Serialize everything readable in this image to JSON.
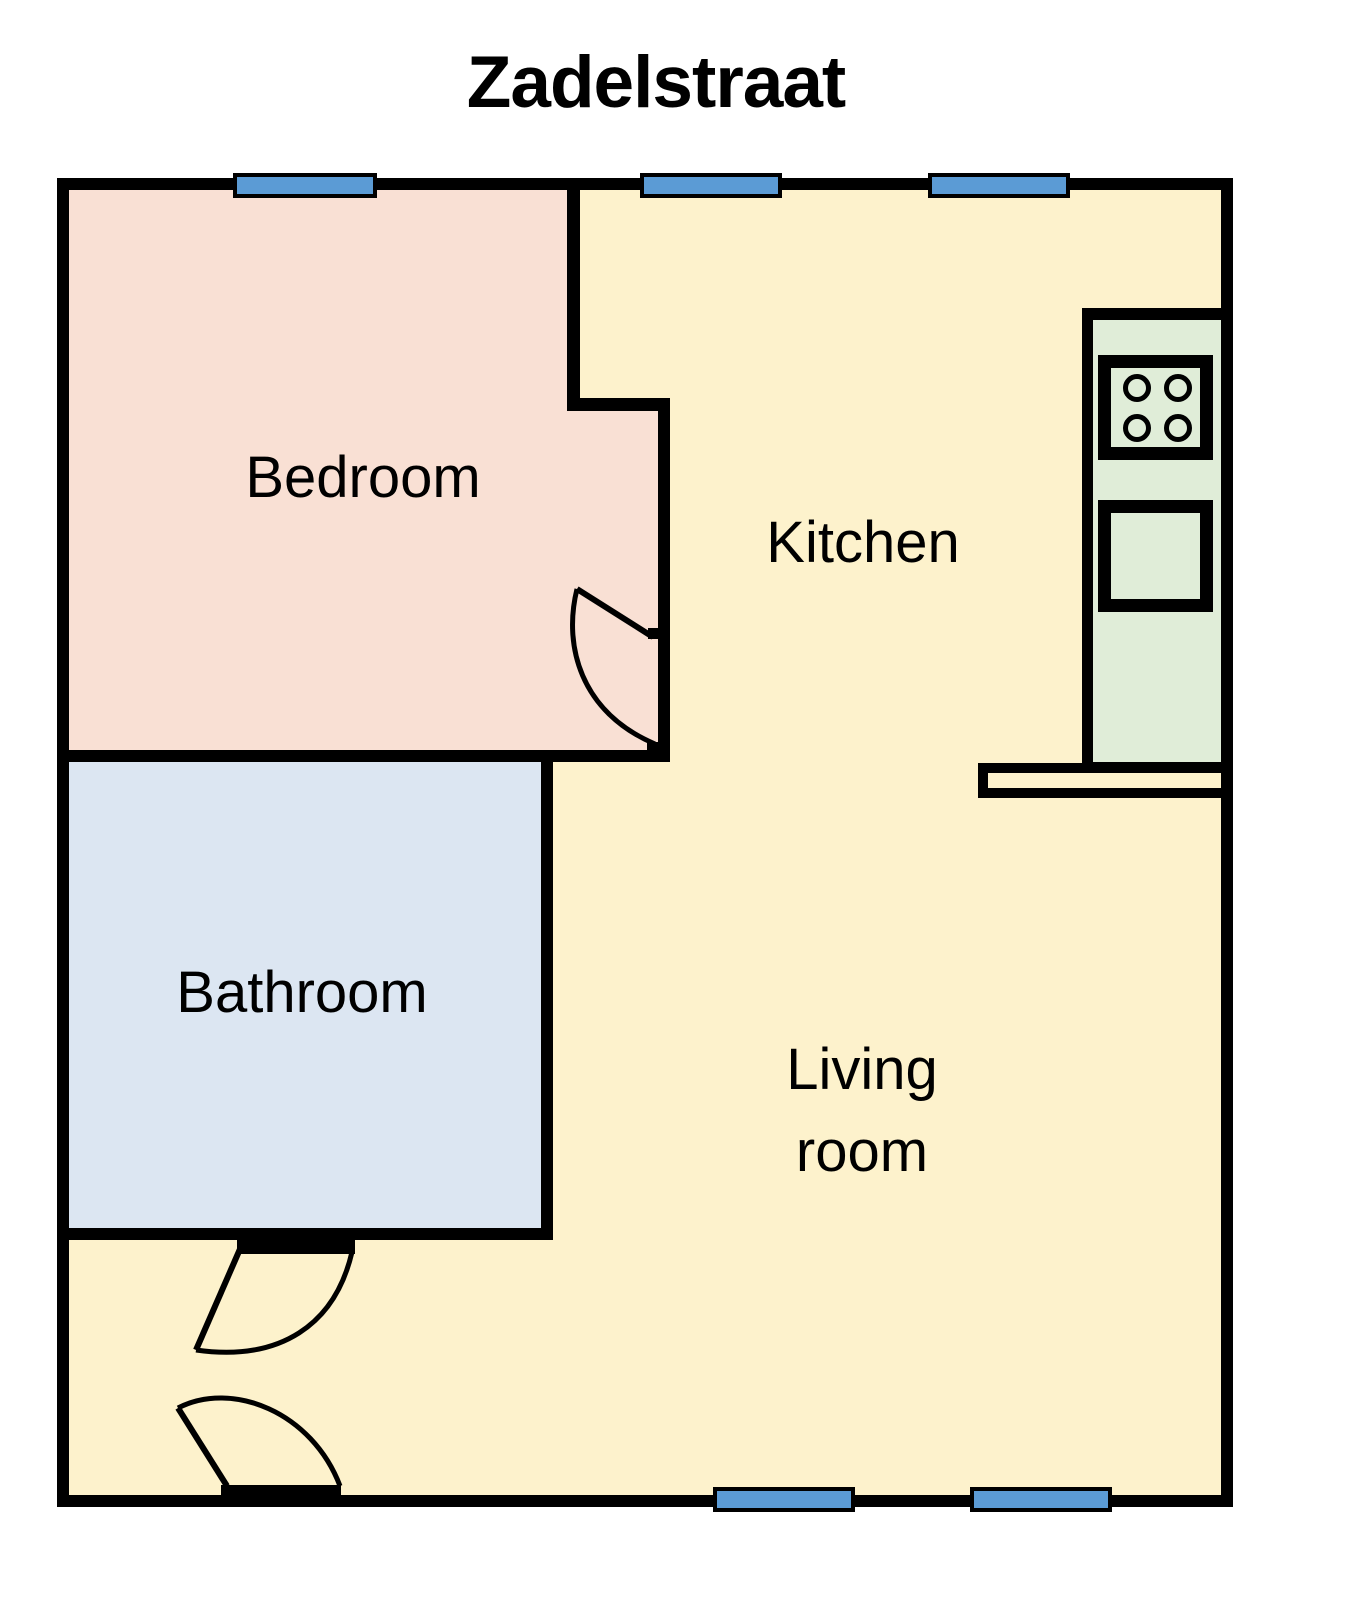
{
  "title": "Zadelstraat",
  "rooms": {
    "bedroom": {
      "label": "Bedroom",
      "fill": "#F9E0D4"
    },
    "kitchen": {
      "label": "Kitchen",
      "fill": "#FDF2CC"
    },
    "bathroom": {
      "label": "Bathroom",
      "fill": "#DCE6F2"
    },
    "living_room": {
      "label_line1": "Living",
      "label_line2": "room",
      "fill": "#FDF2CC"
    }
  },
  "palette": {
    "wall": "#000000",
    "window": "#5B9BD5",
    "counter": "#E0EDD8",
    "background": "#FFFFFF"
  },
  "fixtures": {
    "stove": "stove-four-burners-icon",
    "oven": "oven-icon",
    "counter": "kitchen-counter",
    "breakfast_bar": "counter-peninsula"
  }
}
